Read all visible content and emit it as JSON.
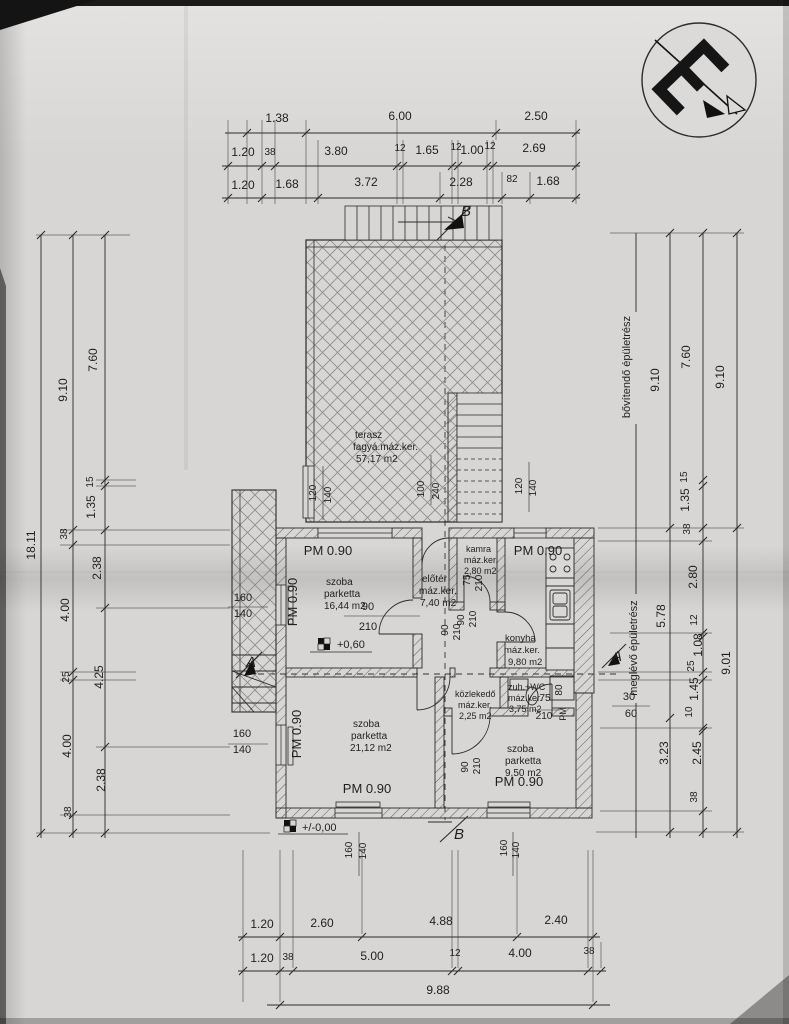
{
  "document": {
    "kind_label": "floor plan drawing",
    "language": "hu"
  },
  "icons": {
    "logo": "architect-monogram-stamp"
  },
  "rooms": [
    {
      "name": "terasz",
      "finish": "fagyá.máz.ker.",
      "area": "57,17 m2"
    },
    {
      "name": "szoba",
      "finish": "parketta",
      "area": "16,44 m2"
    },
    {
      "name": "előtér",
      "finish": "máz.ker.",
      "area": "7,40 m2"
    },
    {
      "name": "kamra",
      "finish": "máz.ker.",
      "area": "2,80 m2"
    },
    {
      "name": "konyha",
      "finish": "máz.ker.",
      "area": "9,80 m2"
    },
    {
      "name": "közlekedő",
      "finish": "máz.ker.",
      "area": "2,25 m2"
    },
    {
      "name": "zuh.+WC",
      "finish": "máz.ker.",
      "area": "3,75 m2"
    },
    {
      "name": "szoba",
      "finish": "parketta",
      "area": "21,12 m2"
    },
    {
      "name": "szoba",
      "finish": "parketta",
      "area": "9,50 m2"
    }
  ],
  "building_part_labels": [
    "bővítendő épületrész",
    "meglévő épületrész"
  ],
  "level_markers": [
    "+0,60",
    "+/-0,00"
  ],
  "section_markers": [
    "A",
    "B"
  ],
  "dimension_chains": {
    "top": [
      [
        "1.38",
        "6.00",
        "2.50"
      ],
      [
        "1.20",
        "38",
        "3.80",
        "12",
        "1.65",
        "12",
        "1.00",
        "12",
        "2.69"
      ],
      [
        "1.20",
        "1.68",
        "3.72",
        "2.28",
        "82",
        "1.68"
      ]
    ],
    "left": [
      [
        "18.11"
      ],
      [
        "9.10",
        "38",
        "4.00",
        "25",
        "4.00",
        "38"
      ],
      [
        "7.60",
        "15",
        "1.35",
        "2.38",
        "4.25",
        "2.38"
      ]
    ],
    "right": [
      [
        "9.10",
        "5.78",
        "3.23"
      ],
      [
        "7.60",
        "15",
        "1.35",
        "38",
        "2.80",
        "12",
        "1.08",
        "25",
        "1.45",
        "10",
        "2.45",
        "38"
      ],
      [
        "9.10",
        "9.01"
      ]
    ],
    "bottom": [
      [
        "1.20",
        "2.60",
        "4.88",
        "2.40"
      ],
      [
        "1.20",
        "38",
        "5.00",
        "12",
        "4.00",
        "38"
      ],
      [
        "9.88"
      ]
    ]
  },
  "texts": [
    {
      "n": "dim-label",
      "t": "1.38",
      "x": 277,
      "y": 122
    },
    {
      "n": "dim-label",
      "t": "6.00",
      "x": 400,
      "y": 120
    },
    {
      "n": "dim-label",
      "t": "2.50",
      "x": 536,
      "y": 120
    },
    {
      "n": "dim-label",
      "t": "1.20",
      "x": 243,
      "y": 156
    },
    {
      "n": "dim-label",
      "t": "38",
      "x": 270,
      "y": 155,
      "s": 10
    },
    {
      "n": "dim-label",
      "t": "3.80",
      "x": 336,
      "y": 155
    },
    {
      "n": "dim-label",
      "t": "12",
      "x": 400,
      "y": 151,
      "s": 10
    },
    {
      "n": "dim-label",
      "t": "1.65",
      "x": 427,
      "y": 154
    },
    {
      "n": "dim-label",
      "t": "12",
      "x": 456,
      "y": 150,
      "s": 10
    },
    {
      "n": "dim-label",
      "t": "1.00",
      "x": 472,
      "y": 154
    },
    {
      "n": "dim-label",
      "t": "12",
      "x": 490,
      "y": 149,
      "s": 10
    },
    {
      "n": "dim-label",
      "t": "2.69",
      "x": 534,
      "y": 152
    },
    {
      "n": "dim-label",
      "t": "1.20",
      "x": 243,
      "y": 189
    },
    {
      "n": "dim-label",
      "t": "1.68",
      "x": 287,
      "y": 188
    },
    {
      "n": "dim-label",
      "t": "3.72",
      "x": 366,
      "y": 186
    },
    {
      "n": "dim-label",
      "t": "2.28",
      "x": 461,
      "y": 186
    },
    {
      "n": "dim-label",
      "t": "82",
      "x": 512,
      "y": 182,
      "s": 10
    },
    {
      "n": "dim-label",
      "t": "1.68",
      "x": 548,
      "y": 185
    },
    {
      "n": "dim-total-left",
      "t": "18.11",
      "x": 35,
      "y": 545,
      "r": -90
    },
    {
      "n": "dim-label",
      "t": "9.10",
      "x": 67,
      "y": 390,
      "r": -90
    },
    {
      "n": "dim-label",
      "t": "38",
      "x": 67,
      "y": 534,
      "r": -90,
      "s": 10
    },
    {
      "n": "dim-label",
      "t": "4.00",
      "x": 69,
      "y": 610,
      "r": -90
    },
    {
      "n": "dim-label",
      "t": "25",
      "x": 69,
      "y": 677,
      "r": -90,
      "s": 10
    },
    {
      "n": "dim-label",
      "t": "4.00",
      "x": 71,
      "y": 746,
      "r": -90
    },
    {
      "n": "dim-label",
      "t": "38",
      "x": 71,
      "y": 812,
      "r": -90,
      "s": 10
    },
    {
      "n": "dim-label",
      "t": "7.60",
      "x": 97,
      "y": 360,
      "r": -90
    },
    {
      "n": "dim-label",
      "t": "15",
      "x": 93,
      "y": 482,
      "r": -90,
      "s": 10
    },
    {
      "n": "dim-label",
      "t": "1.35",
      "x": 95,
      "y": 507,
      "r": -90
    },
    {
      "n": "dim-label",
      "t": "2.38",
      "x": 101,
      "y": 568,
      "r": -90
    },
    {
      "n": "dim-label",
      "t": "4.25",
      "x": 103,
      "y": 677,
      "r": -90
    },
    {
      "n": "dim-label",
      "t": "2.38",
      "x": 105,
      "y": 780,
      "r": -90
    },
    {
      "n": "label-building-extend",
      "t": "bővítendő épületrész",
      "x": 630,
      "y": 367,
      "r": -90,
      "s": 11
    },
    {
      "n": "label-building-existing",
      "t": "meglévő épületrész",
      "x": 637,
      "y": 648,
      "r": -90,
      "s": 11
    },
    {
      "n": "dim-label",
      "t": "9.10",
      "x": 659,
      "y": 380,
      "r": -90
    },
    {
      "n": "dim-label",
      "t": "5.78",
      "x": 665,
      "y": 616,
      "r": -90
    },
    {
      "n": "dim-label",
      "t": "3.23",
      "x": 668,
      "y": 753,
      "r": -90
    },
    {
      "n": "dim-label",
      "t": "7.60",
      "x": 690,
      "y": 357,
      "r": -90
    },
    {
      "n": "dim-label",
      "t": "15",
      "x": 687,
      "y": 477,
      "r": -90,
      "s": 10
    },
    {
      "n": "dim-label",
      "t": "1.35",
      "x": 689,
      "y": 500,
      "r": -90
    },
    {
      "n": "dim-label",
      "t": "38",
      "x": 690,
      "y": 529,
      "r": -90,
      "s": 10
    },
    {
      "n": "dim-label",
      "t": "2.80",
      "x": 697,
      "y": 577,
      "r": -90
    },
    {
      "n": "dim-label",
      "t": "12",
      "x": 697,
      "y": 620,
      "r": -90,
      "s": 10
    },
    {
      "n": "dim-label",
      "t": "1.08",
      "x": 702,
      "y": 645,
      "r": -90
    },
    {
      "n": "dim-label",
      "t": "25",
      "x": 694,
      "y": 666,
      "r": -90,
      "s": 10
    },
    {
      "n": "dim-label",
      "t": "1.45",
      "x": 698,
      "y": 689,
      "r": -90
    },
    {
      "n": "dim-label",
      "t": "10",
      "x": 692,
      "y": 712,
      "r": -90,
      "s": 10
    },
    {
      "n": "dim-label",
      "t": "2.45",
      "x": 701,
      "y": 753,
      "r": -90
    },
    {
      "n": "dim-label",
      "t": "38",
      "x": 697,
      "y": 797,
      "r": -90,
      "s": 10
    },
    {
      "n": "dim-label",
      "t": "9.10",
      "x": 724,
      "y": 377,
      "r": -90
    },
    {
      "n": "dim-total-right",
      "t": "9.01",
      "x": 730,
      "y": 663,
      "r": -90
    },
    {
      "n": "dim-label",
      "t": "1.20",
      "x": 262,
      "y": 928
    },
    {
      "n": "dim-label",
      "t": "2.60",
      "x": 322,
      "y": 927
    },
    {
      "n": "dim-label",
      "t": "4.88",
      "x": 441,
      "y": 925
    },
    {
      "n": "dim-label",
      "t": "2.40",
      "x": 556,
      "y": 924
    },
    {
      "n": "dim-label",
      "t": "1.20",
      "x": 262,
      "y": 962
    },
    {
      "n": "dim-label",
      "t": "38",
      "x": 288,
      "y": 960,
      "s": 10
    },
    {
      "n": "dim-label",
      "t": "5.00",
      "x": 372,
      "y": 960
    },
    {
      "n": "dim-label",
      "t": "12",
      "x": 455,
      "y": 956,
      "s": 10
    },
    {
      "n": "dim-label",
      "t": "4.00",
      "x": 520,
      "y": 957
    },
    {
      "n": "dim-label",
      "t": "38",
      "x": 589,
      "y": 954,
      "s": 10
    },
    {
      "n": "dim-total-bottom",
      "t": "9.88",
      "x": 438,
      "y": 994
    },
    {
      "n": "room-terasz-name",
      "t": "terasz",
      "x": 355,
      "y": 438,
      "a": "start",
      "s": 10
    },
    {
      "n": "room-terasz-finish",
      "t": "fagyá.máz.ker.",
      "x": 353,
      "y": 450,
      "a": "start",
      "s": 10
    },
    {
      "n": "room-terasz-area",
      "t": "57,17 m2",
      "x": 356,
      "y": 462,
      "a": "start",
      "s": 10
    },
    {
      "n": "room-szoba1-name",
      "t": "szoba",
      "x": 326,
      "y": 585,
      "a": "start",
      "s": 10
    },
    {
      "n": "room-szoba1-finish",
      "t": "parketta",
      "x": 324,
      "y": 597,
      "a": "start",
      "s": 10
    },
    {
      "n": "room-szoba1-area",
      "t": "16,44 m2",
      "x": 324,
      "y": 609,
      "a": "start",
      "s": 10
    },
    {
      "n": "room-eloter-name",
      "t": "előtér",
      "x": 422,
      "y": 582,
      "a": "start",
      "s": 10
    },
    {
      "n": "room-eloter-finish",
      "t": "máz.ker.",
      "x": 419,
      "y": 594,
      "a": "start",
      "s": 10
    },
    {
      "n": "room-eloter-area",
      "t": "7,40 m2",
      "x": 420,
      "y": 606,
      "a": "start",
      "s": 10
    },
    {
      "n": "room-kamra-name",
      "t": "kamra",
      "x": 466,
      "y": 552,
      "a": "start",
      "s": 9
    },
    {
      "n": "room-kamra-finish",
      "t": "máz.ker.",
      "x": 464,
      "y": 563,
      "a": "start",
      "s": 9
    },
    {
      "n": "room-kamra-area",
      "t": "2,80 m2",
      "x": 464,
      "y": 574,
      "a": "start",
      "s": 9
    },
    {
      "n": "room-konyha-name",
      "t": "konyha",
      "x": 505,
      "y": 641,
      "a": "start",
      "s": 9.5
    },
    {
      "n": "room-konyha-finish",
      "t": "máz.ker.",
      "x": 504,
      "y": 653,
      "a": "start",
      "s": 9.5
    },
    {
      "n": "room-konyha-area",
      "t": "9,80 m2",
      "x": 508,
      "y": 665,
      "a": "start",
      "s": 9.5
    },
    {
      "n": "room-kozlekedo-name",
      "t": "közlekedő",
      "x": 455,
      "y": 697,
      "a": "start",
      "s": 9
    },
    {
      "n": "room-kozlekedo-finish",
      "t": "máz.ker.",
      "x": 458,
      "y": 708,
      "a": "start",
      "s": 9
    },
    {
      "n": "room-kozlekedo-area",
      "t": "2,25 m2",
      "x": 459,
      "y": 719,
      "a": "start",
      "s": 9
    },
    {
      "n": "room-wc-name",
      "t": "zuh.+WC",
      "x": 508,
      "y": 690,
      "a": "start",
      "s": 9
    },
    {
      "n": "room-wc-finish",
      "t": "máz.ker.",
      "x": 508,
      "y": 701,
      "a": "start",
      "s": 9
    },
    {
      "n": "room-wc-area",
      "t": "3,75 m2",
      "x": 509,
      "y": 712,
      "a": "start",
      "s": 9
    },
    {
      "n": "room-szoba2-name",
      "t": "szoba",
      "x": 353,
      "y": 727,
      "a": "start",
      "s": 10
    },
    {
      "n": "room-szoba2-finish",
      "t": "parketta",
      "x": 351,
      "y": 739,
      "a": "start",
      "s": 10
    },
    {
      "n": "room-szoba2-area",
      "t": "21,12 m2",
      "x": 350,
      "y": 751,
      "a": "start",
      "s": 10
    },
    {
      "n": "room-szoba3-name",
      "t": "szoba",
      "x": 507,
      "y": 752,
      "a": "start",
      "s": 10
    },
    {
      "n": "room-szoba3-finish",
      "t": "parketta",
      "x": 505,
      "y": 764,
      "a": "start",
      "s": 10
    },
    {
      "n": "room-szoba3-area",
      "t": "9,50 m2",
      "x": 505,
      "y": 776,
      "a": "start",
      "s": 10
    },
    {
      "n": "parapet-label",
      "t": "PM 0.90",
      "x": 328,
      "y": 555,
      "s": 13
    },
    {
      "n": "parapet-label",
      "t": "PM 0.90",
      "x": 297,
      "y": 602,
      "r": -90,
      "s": 13
    },
    {
      "n": "parapet-label",
      "t": "PM 0.90",
      "x": 538,
      "y": 555,
      "s": 13
    },
    {
      "n": "parapet-label",
      "t": "PM 0.90",
      "x": 301,
      "y": 734,
      "r": -90,
      "s": 13
    },
    {
      "n": "parapet-label",
      "t": "PM 0.90",
      "x": 367,
      "y": 793,
      "s": 13
    },
    {
      "n": "parapet-label",
      "t": "PM 0.90",
      "x": 519,
      "y": 786,
      "s": 13
    },
    {
      "n": "parapet-label",
      "t": "PM",
      "x": 566,
      "y": 714,
      "r": -90,
      "s": 9
    },
    {
      "n": "door-dim",
      "t": "90",
      "x": 368,
      "y": 610,
      "s": 11
    },
    {
      "n": "door-dim",
      "t": "210",
      "x": 368,
      "y": 630,
      "s": 11
    },
    {
      "n": "door-dim",
      "t": "90",
      "x": 448,
      "y": 630,
      "r": -90,
      "s": 10
    },
    {
      "n": "door-dim",
      "t": "210",
      "x": 460,
      "y": 632,
      "r": -90,
      "s": 10
    },
    {
      "n": "door-dim",
      "t": "75",
      "x": 470,
      "y": 580,
      "r": -90,
      "s": 10
    },
    {
      "n": "door-dim",
      "t": "210",
      "x": 482,
      "y": 583,
      "r": -90,
      "s": 10
    },
    {
      "n": "door-dim",
      "t": "90",
      "x": 464,
      "y": 620,
      "r": -90,
      "s": 10
    },
    {
      "n": "door-dim",
      "t": "210",
      "x": 476,
      "y": 619,
      "r": -90,
      "s": 10
    },
    {
      "n": "door-dim",
      "t": "75",
      "x": 545,
      "y": 701,
      "s": 10
    },
    {
      "n": "door-dim",
      "t": "210",
      "x": 544,
      "y": 719,
      "s": 10
    },
    {
      "n": "door-dim",
      "t": "90",
      "x": 468,
      "y": 767,
      "r": -90,
      "s": 10
    },
    {
      "n": "door-dim",
      "t": "210",
      "x": 480,
      "y": 766,
      "r": -90,
      "s": 10
    },
    {
      "n": "fixture-dim",
      "t": "80",
      "x": 562,
      "y": 690,
      "r": -90,
      "s": 10
    },
    {
      "n": "wall-dim",
      "t": "30",
      "x": 629,
      "y": 700,
      "s": 11
    },
    {
      "n": "wall-dim",
      "t": "60",
      "x": 631,
      "y": 717,
      "s": 11
    },
    {
      "n": "window-dim",
      "t": "120",
      "x": 316,
      "y": 493,
      "r": -90,
      "s": 10
    },
    {
      "n": "window-dim",
      "t": "140",
      "x": 331,
      "y": 495,
      "r": -90,
      "s": 10
    },
    {
      "n": "window-dim",
      "t": "100",
      "x": 424,
      "y": 489,
      "r": -90,
      "s": 10
    },
    {
      "n": "window-dim",
      "t": "240",
      "x": 439,
      "y": 491,
      "r": -90,
      "s": 10
    },
    {
      "n": "window-dim",
      "t": "120",
      "x": 522,
      "y": 486,
      "r": -90,
      "s": 10
    },
    {
      "n": "window-dim",
      "t": "140",
      "x": 536,
      "y": 488,
      "r": -90,
      "s": 10
    },
    {
      "n": "window-dim",
      "t": "160",
      "x": 352,
      "y": 850,
      "r": -90,
      "s": 10
    },
    {
      "n": "window-dim",
      "t": "140",
      "x": 366,
      "y": 851,
      "r": -90,
      "s": 10
    },
    {
      "n": "window-dim",
      "t": "160",
      "x": 507,
      "y": 848,
      "r": -90,
      "s": 10
    },
    {
      "n": "window-dim",
      "t": "140",
      "x": 519,
      "y": 850,
      "r": -90,
      "s": 10
    },
    {
      "n": "window-dim",
      "t": "160",
      "x": 243,
      "y": 601,
      "s": 11
    },
    {
      "n": "window-dim",
      "t": "140",
      "x": 243,
      "y": 617,
      "s": 11
    },
    {
      "n": "window-dim",
      "t": "160",
      "x": 242,
      "y": 737,
      "s": 11
    },
    {
      "n": "window-dim",
      "t": "140",
      "x": 242,
      "y": 753,
      "s": 11
    },
    {
      "n": "level-marker-label",
      "t": "+0,60",
      "x": 337,
      "y": 648,
      "a": "start",
      "s": 11
    },
    {
      "n": "level-marker-label",
      "t": "+/-0,00",
      "x": 302,
      "y": 831,
      "a": "start",
      "s": 11
    },
    {
      "n": "section-marker-label",
      "t": "B",
      "x": 466,
      "y": 216,
      "s": 15,
      "f": "serif"
    },
    {
      "n": "section-marker-label",
      "t": "B",
      "x": 459,
      "y": 839,
      "s": 15,
      "f": "serif"
    },
    {
      "n": "section-marker-label",
      "t": "A",
      "x": 251,
      "y": 667,
      "s": 15,
      "f": "serif"
    },
    {
      "n": "section-marker-label",
      "t": "A",
      "x": 617,
      "y": 661,
      "s": 15,
      "f": "serif"
    }
  ]
}
